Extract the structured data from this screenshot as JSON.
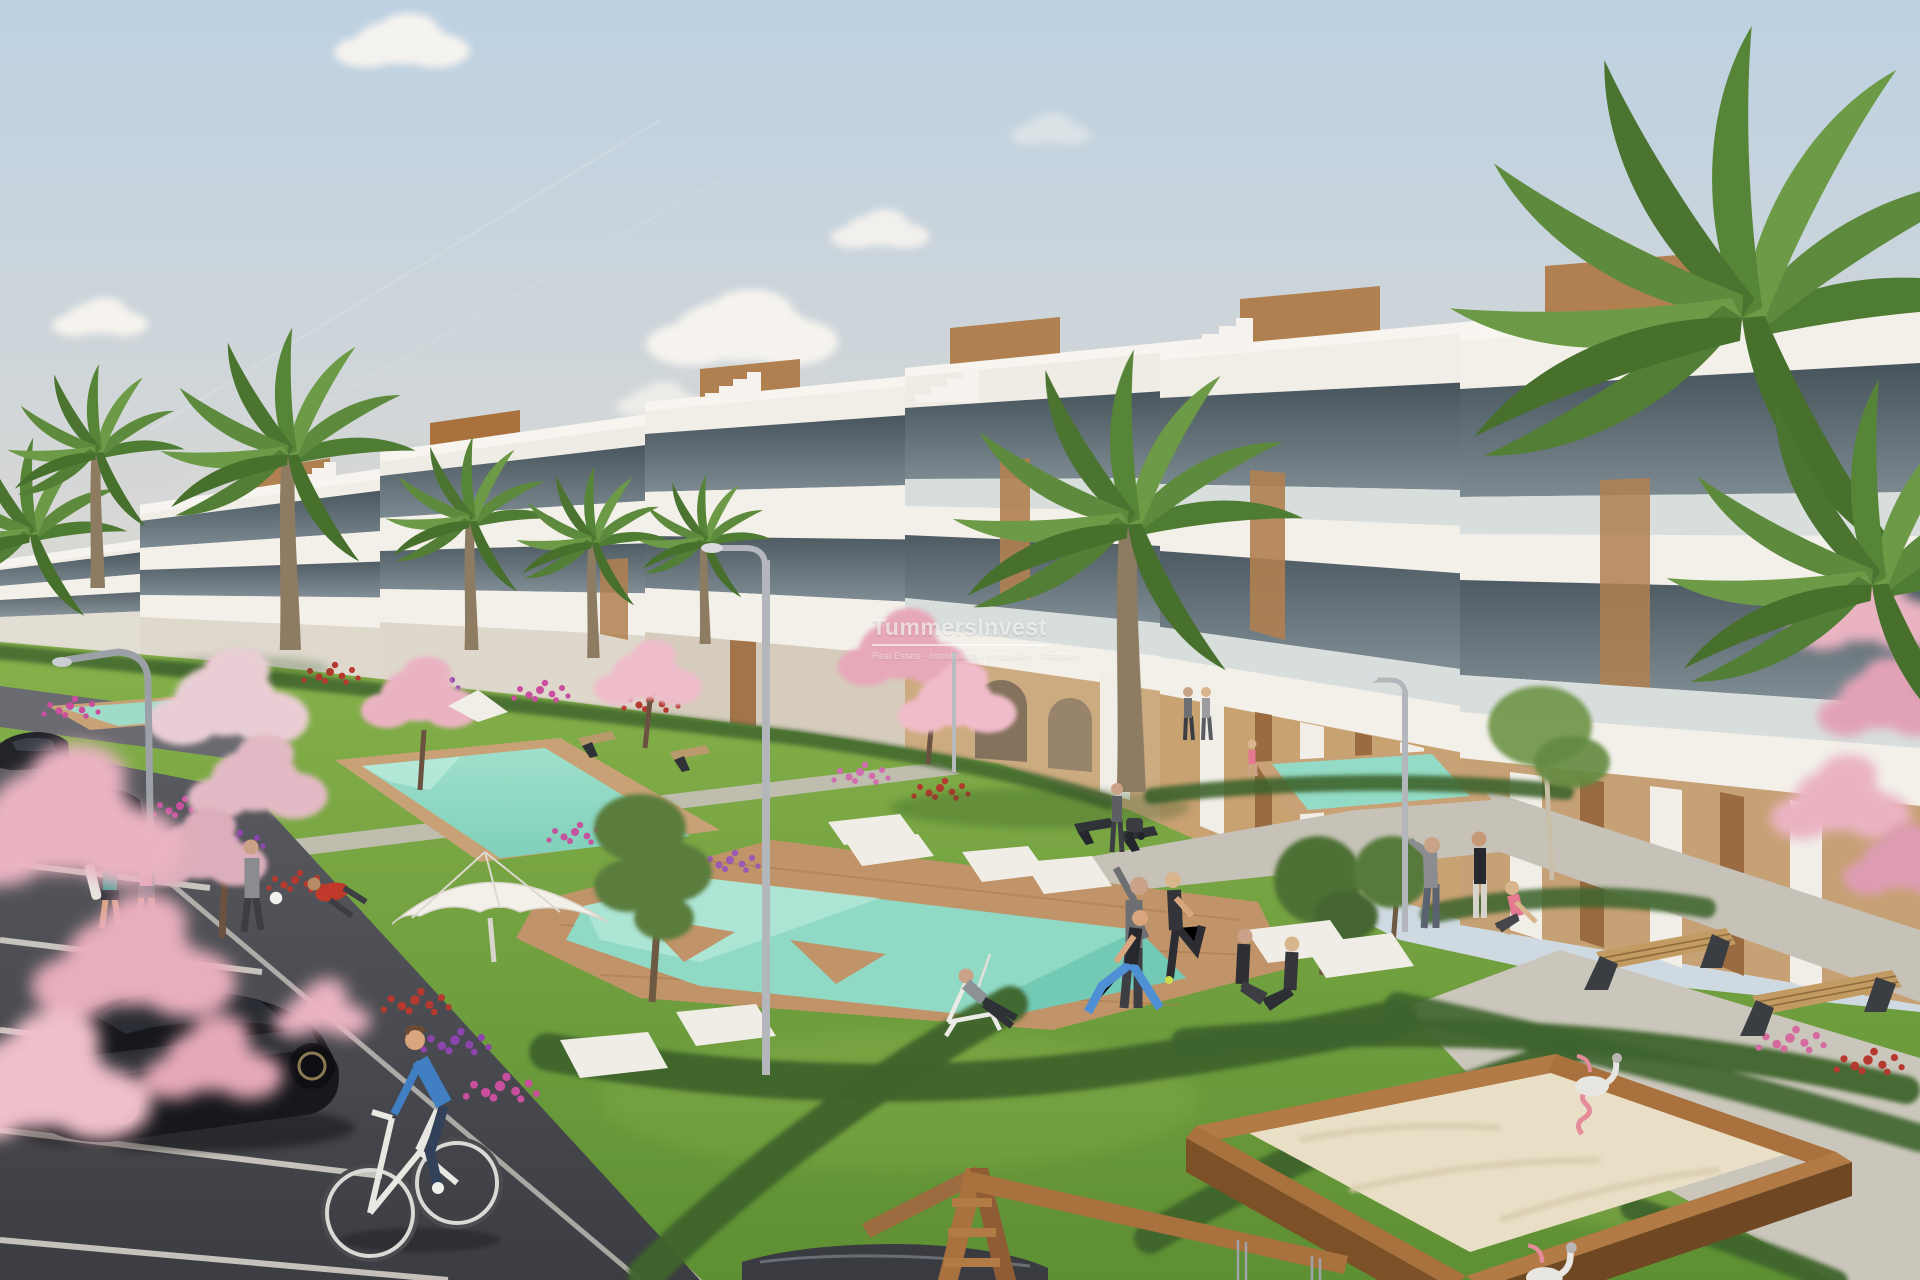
{
  "meta": {
    "kind": "architectural-render-photo",
    "width_px": 1920,
    "height_px": 1280
  },
  "watermark": {
    "title": "TummersInvest",
    "tagline": "Real Estate - Inmobiliaria - Immobilien - Vastgoed"
  },
  "palette": {
    "sky_top": "#bdd1e2",
    "sky_horizon": "#efe5d6",
    "cloud": "#f8f5f0",
    "building_white": "#f1eee7",
    "building_shadow": "#d9d4ca",
    "glass_dark": "#46535b",
    "glass_light": "#7d8a92",
    "wood_accent": "#b08050",
    "arcade_tan": "#c9a272",
    "grass_light": "#86b14b",
    "grass_dark": "#5d8f33",
    "hedge": "#3e642d",
    "pool": "#8fd9c5",
    "pool_light": "#c7efe1",
    "deck_wood": "#c09468",
    "path_grey": "#c3bfb4",
    "asphalt": "#48494e",
    "line_white": "#ddd9d0",
    "sand": "#e9dfc6",
    "sandbox_wood": "#a9713d",
    "blossom_pink": "#eab3c2",
    "flower_magenta": "#c94f9e",
    "flower_red": "#b5392f",
    "flower_purple": "#8e44ad",
    "palm_green": "#5d8a3c",
    "car_black": "#17181c",
    "cyclist_blue": "#3f7fc2",
    "swan_pink": "#e58b9a",
    "metal_grey": "#b3b6ba"
  },
  "scene": {
    "elements": [
      "sky",
      "clouds",
      "contrails",
      "apartment-building-row",
      "rooftop-cabins",
      "rooftop-stairs",
      "balcony-glass",
      "window-glass-bands",
      "ground-floor-arcade",
      "lawns",
      "flower-beds",
      "hedges",
      "walkways",
      "parking-lot",
      "parking-lines",
      "black-hatchback-car",
      "distant-parked-cars",
      "foreground-car-roof",
      "cyclist",
      "main-swimming-pool",
      "upper-swimming-pools",
      "wooden-pool-deck",
      "sun-loungers",
      "parasols",
      "deckchair-man",
      "joggers",
      "footballer",
      "reaching-man",
      "exercise-group",
      "stretching-man",
      "seated-pair",
      "pole-stretch-man",
      "standing-woman",
      "sitting-woman",
      "stroller-person",
      "walking-couple",
      "child",
      "park-benches",
      "plaza-benches",
      "palm-trees",
      "cherry-blossom-trees",
      "olive-trees",
      "young-tree",
      "street-lamps",
      "playground-sandbox",
      "swan-spring-riders",
      "wooden-swing-frame",
      "watermark"
    ]
  }
}
